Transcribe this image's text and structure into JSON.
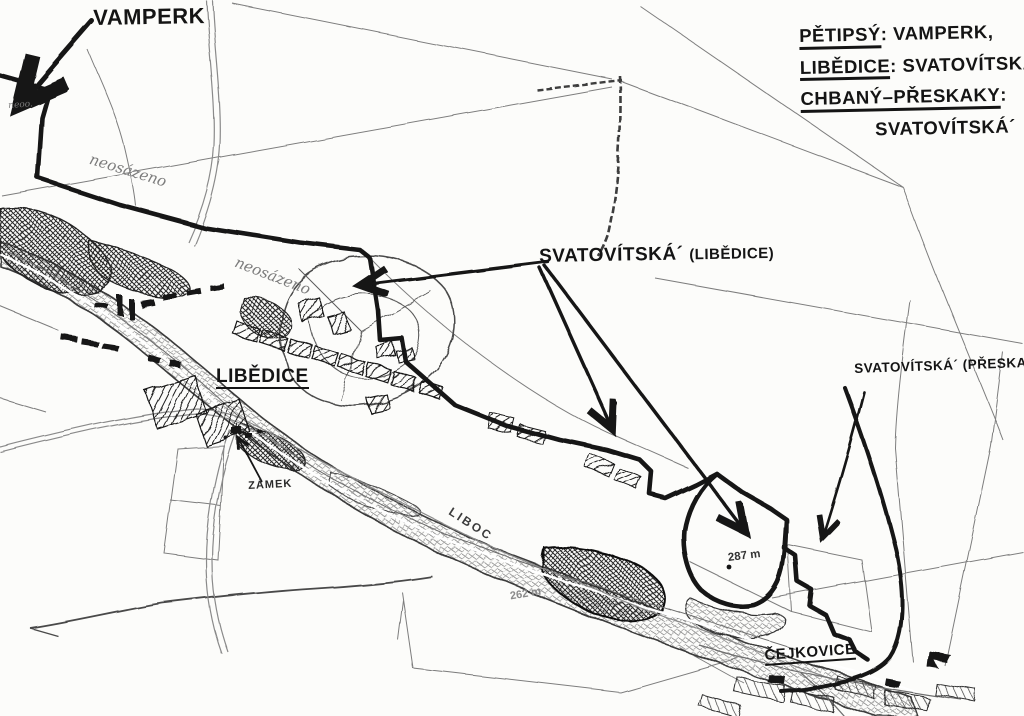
{
  "labels": {
    "vamperk": "VAMPERK",
    "svatovitska_libedice_main": "SVATOVÍTSKÁ´",
    "svatovitska_libedice_paren": "(LIBĚDICE)",
    "svatovitska_preskaky": "SVATOVÍTSKÁ´ (PŘESKAKY)",
    "village_libedice": "LIBĚDICE",
    "village_cejkovice": "ČEJKOVICE",
    "zamek": "ZÁMEK",
    "river_liboc": "LIBOC",
    "note_neosazeno_1": "neosázeno",
    "note_neosazeno_2": "neosázeno",
    "note_small": "neoo.",
    "elev_287": "287 m",
    "elev_262": "262 m"
  },
  "legend": {
    "line1_term": "PĚTIPSÝ",
    "line1_value": ": VAMPERK,",
    "line2_term": "LIBĚDICE",
    "line2_value": ": SVATOVÍTSKÁ´",
    "line3_term": "CHBANÝ–PŘESKAKY",
    "line3_value": ":",
    "line4_value": "SVATOVÍTSKÁ´"
  },
  "colors": {
    "paper": "#fcfcfa",
    "ink": "#141414",
    "pencil": "#6e6e6e",
    "pencil_light": "#9a9a9a"
  }
}
